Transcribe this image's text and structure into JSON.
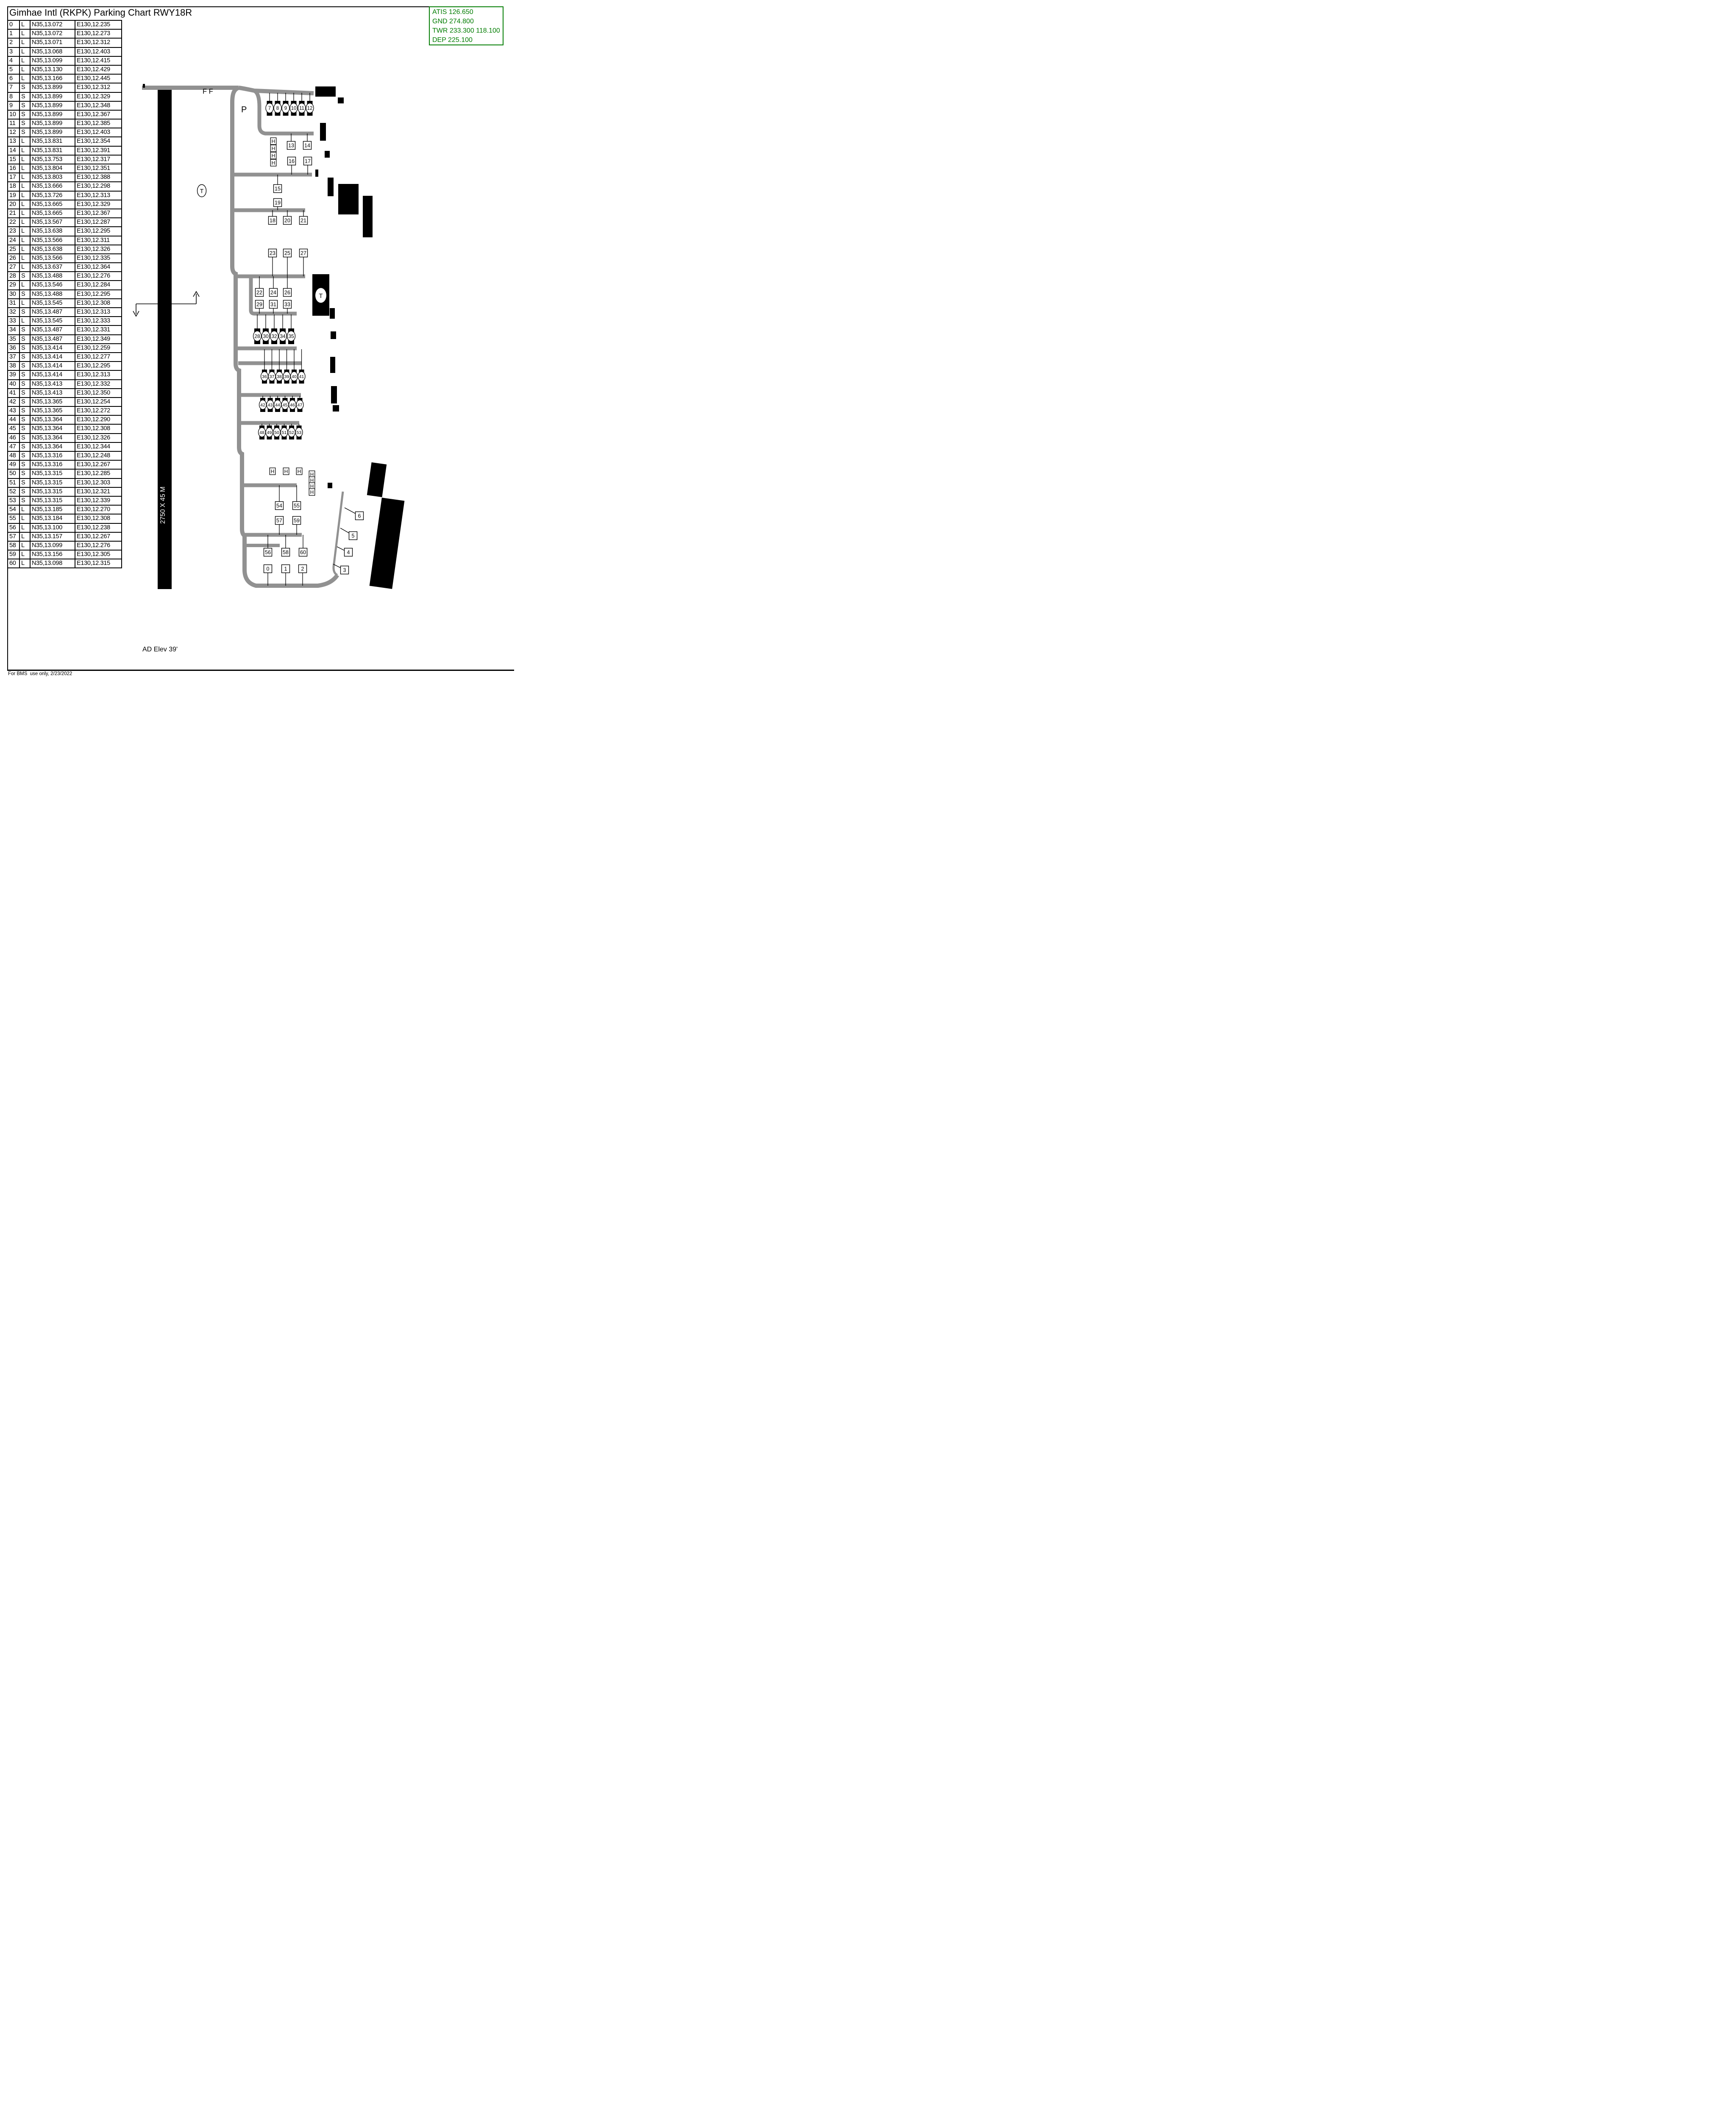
{
  "title": "Gimhae Intl (RKPK) Parking Chart RWY18R",
  "frequencies": {
    "atis": "ATIS 126.650",
    "gnd": "GND 274.800",
    "twr": "TWR 233.300 118.100",
    "dep": "DEP 225.100",
    "color": "#007c00"
  },
  "parking_table": {
    "rows": [
      [
        "0",
        "L",
        "N35,13.072",
        "E130,12.235"
      ],
      [
        "1",
        "L",
        "N35,13.072",
        "E130,12.273"
      ],
      [
        "2",
        "L",
        "N35,13.071",
        "E130,12.312"
      ],
      [
        "3",
        "L",
        "N35,13.068",
        "E130,12.403"
      ],
      [
        "4",
        "L",
        "N35,13.099",
        "E130,12.415"
      ],
      [
        "5",
        "L",
        "N35,13.130",
        "E130,12.429"
      ],
      [
        "6",
        "L",
        "N35,13.166",
        "E130,12.445"
      ],
      [
        "7",
        "S",
        "N35,13.899",
        "E130,12.312"
      ],
      [
        "8",
        "S",
        "N35,13.899",
        "E130,12.329"
      ],
      [
        "9",
        "S",
        "N35,13.899",
        "E130,12.348"
      ],
      [
        "10",
        "S",
        "N35,13.899",
        "E130,12.367"
      ],
      [
        "11",
        "S",
        "N35,13.899",
        "E130,12.385"
      ],
      [
        "12",
        "S",
        "N35,13.899",
        "E130,12.403"
      ],
      [
        "13",
        "L",
        "N35,13.831",
        "E130,12.354"
      ],
      [
        "14",
        "L",
        "N35,13.831",
        "E130,12.391"
      ],
      [
        "15",
        "L",
        "N35,13.753",
        "E130,12.317"
      ],
      [
        "16",
        "L",
        "N35,13.804",
        "E130,12.351"
      ],
      [
        "17",
        "L",
        "N35,13.803",
        "E130,12.388"
      ],
      [
        "18",
        "L",
        "N35,13.666",
        "E130,12.298"
      ],
      [
        "19",
        "L",
        "N35,13.726",
        "E130,12.313"
      ],
      [
        "20",
        "L",
        "N35,13.665",
        "E130,12.329"
      ],
      [
        "21",
        "L",
        "N35,13.665",
        "E130,12.367"
      ],
      [
        "22",
        "L",
        "N35,13.567",
        "E130,12.287"
      ],
      [
        "23",
        "L",
        "N35,13.638",
        "E130,12.295"
      ],
      [
        "24",
        "L",
        "N35,13.566",
        "E130,12.311"
      ],
      [
        "25",
        "L",
        "N35,13.638",
        "E130,12.326"
      ],
      [
        "26",
        "L",
        "N35,13.566",
        "E130,12.335"
      ],
      [
        "27",
        "L",
        "N35,13.637",
        "E130,12.364"
      ],
      [
        "28",
        "S",
        "N35,13.488",
        "E130,12.276"
      ],
      [
        "29",
        "L",
        "N35,13.546",
        "E130,12.284"
      ],
      [
        "30",
        "S",
        "N35,13.488",
        "E130,12.295"
      ],
      [
        "31",
        "L",
        "N35,13.545",
        "E130,12.308"
      ],
      [
        "32",
        "S",
        "N35,13.487",
        "E130,12.313"
      ],
      [
        "33",
        "L",
        "N35,13.545",
        "E130,12.333"
      ],
      [
        "34",
        "S",
        "N35,13.487",
        "E130,12.331"
      ],
      [
        "35",
        "S",
        "N35,13.487",
        "E130,12.349"
      ],
      [
        "36",
        "S",
        "N35,13.414",
        "E130,12.259"
      ],
      [
        "37",
        "S",
        "N35,13.414",
        "E130,12.277"
      ],
      [
        "38",
        "S",
        "N35,13.414",
        "E130,12.295"
      ],
      [
        "39",
        "S",
        "N35,13.414",
        "E130,12.313"
      ],
      [
        "40",
        "S",
        "N35,13.413",
        "E130,12.332"
      ],
      [
        "41",
        "S",
        "N35,13.413",
        "E130,12.350"
      ],
      [
        "42",
        "S",
        "N35,13.365",
        "E130,12.254"
      ],
      [
        "43",
        "S",
        "N35,13.365",
        "E130,12.272"
      ],
      [
        "44",
        "S",
        "N35,13.364",
        "E130,12.290"
      ],
      [
        "45",
        "S",
        "N35,13.364",
        "E130,12.308"
      ],
      [
        "46",
        "S",
        "N35,13.364",
        "E130,12.326"
      ],
      [
        "47",
        "S",
        "N35,13.364",
        "E130,12.344"
      ],
      [
        "48",
        "S",
        "N35,13.316",
        "E130,12.248"
      ],
      [
        "49",
        "S",
        "N35,13.316",
        "E130,12.267"
      ],
      [
        "50",
        "S",
        "N35,13.315",
        "E130,12.285"
      ],
      [
        "51",
        "S",
        "N35,13.315",
        "E130,12.303"
      ],
      [
        "52",
        "S",
        "N35,13.315",
        "E130,12.321"
      ],
      [
        "53",
        "S",
        "N35,13.315",
        "E130,12.339"
      ],
      [
        "54",
        "L",
        "N35,13.185",
        "E130,12.270"
      ],
      [
        "55",
        "L",
        "N35,13.184",
        "E130,12.308"
      ],
      [
        "56",
        "L",
        "N35,13.100",
        "E130,12.238"
      ],
      [
        "57",
        "L",
        "N35,13.157",
        "E130,12.267"
      ],
      [
        "58",
        "L",
        "N35,13.099",
        "E130,12.276"
      ],
      [
        "59",
        "L",
        "N35,13.156",
        "E130,12.305"
      ],
      [
        "60",
        "L",
        "N35,13.098",
        "E130,12.315"
      ]
    ]
  },
  "diagram": {
    "runway_label": "2750 X 45 M",
    "labels": {
      "ff": "F F",
      "p": "P",
      "t_left": "T",
      "t_right": "T"
    },
    "stand_groups": {
      "jet_stands_top": [
        "7",
        "8",
        "9",
        "10",
        "11",
        "12"
      ],
      "row_13": [
        "13",
        "14"
      ],
      "row_16": [
        "16",
        "17"
      ],
      "s15": [
        "15"
      ],
      "s19": [
        "19"
      ],
      "row_18": [
        "18",
        "20",
        "21"
      ],
      "row_23": [
        "23",
        "25",
        "27"
      ],
      "row_22": [
        "22",
        "24",
        "26"
      ],
      "row_29": [
        "29",
        "31",
        "33"
      ],
      "stands_28": [
        "28",
        "30",
        "32",
        "34",
        "35"
      ],
      "stands_36": [
        "36",
        "37",
        "38",
        "39",
        "40",
        "41"
      ],
      "stands_42": [
        "42",
        "43",
        "44",
        "45",
        "46",
        "47"
      ],
      "stands_48": [
        "48",
        "49",
        "50",
        "51",
        "52",
        "53"
      ],
      "row_54": [
        "54",
        "55"
      ],
      "row_57": [
        "57",
        "59"
      ],
      "row_56": [
        "56",
        "58",
        "60"
      ],
      "row_0": [
        "0",
        "1",
        "2"
      ],
      "diag_stands": [
        "6",
        "5",
        "4",
        "3"
      ]
    },
    "helipads": {
      "top_column": [
        "H",
        "H",
        "H",
        "H"
      ],
      "bottom_row": [
        "H",
        "H",
        "H"
      ],
      "bottom_column": [
        "H",
        "H",
        "H",
        "H"
      ]
    },
    "taxiway_color": "#919191",
    "ad_elev": "AD Elev 39'"
  },
  "footer": {
    "note": "For BMS  use only, 2/23/2022"
  }
}
